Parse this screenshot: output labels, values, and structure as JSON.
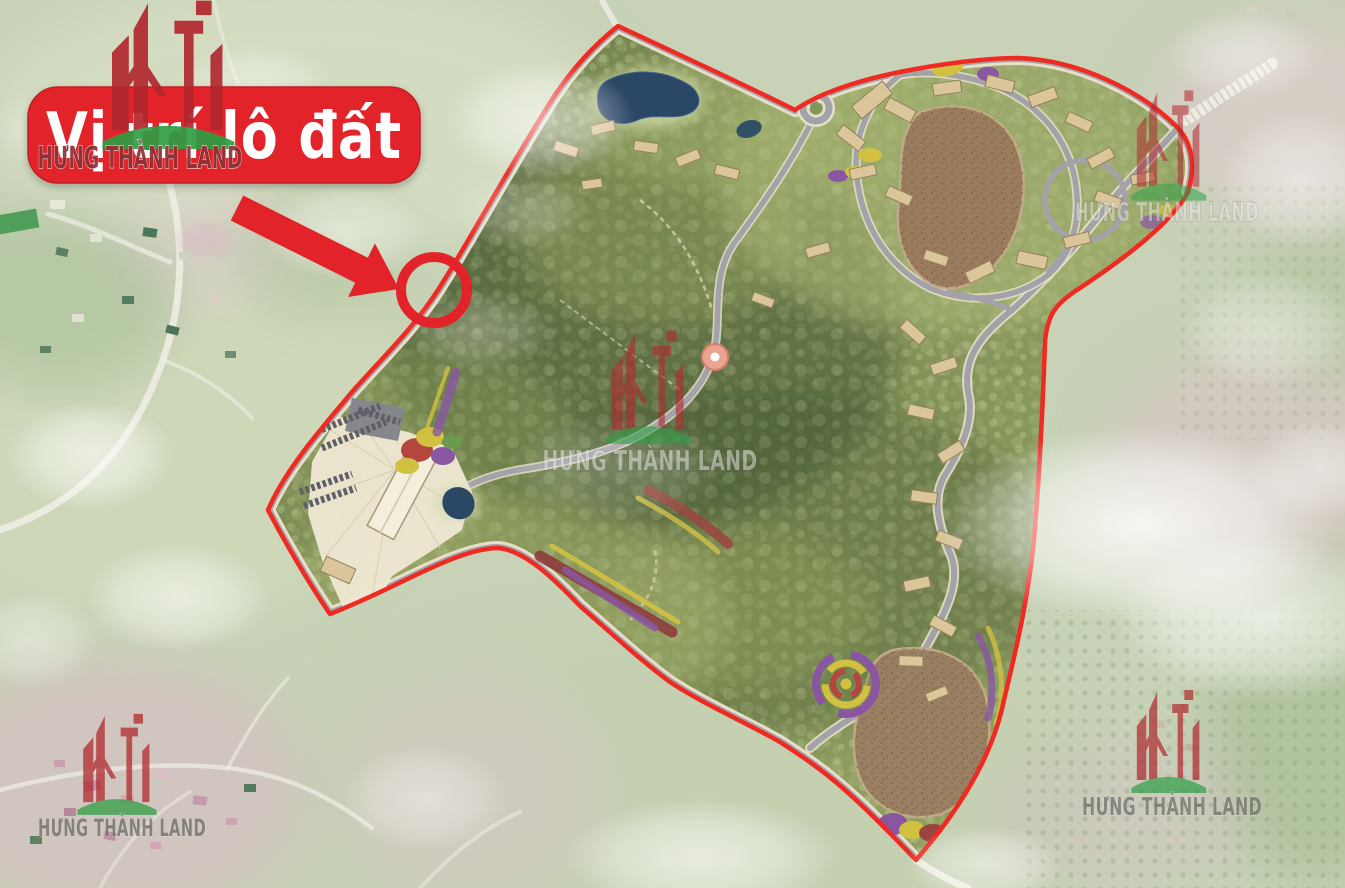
{
  "banner": {
    "label": "Vị trí lô đất",
    "background": "#e2232a",
    "text_color": "#ffffff"
  },
  "brand": {
    "name": "HƯNG THÀNH LAND",
    "logo_building_color": "#b0282e",
    "logo_hill_color": "#2f9e46"
  },
  "annotations": {
    "arrow_color": "#e2232a",
    "ring_color": "#e2232a",
    "boundary_color": "#ee2a22"
  }
}
